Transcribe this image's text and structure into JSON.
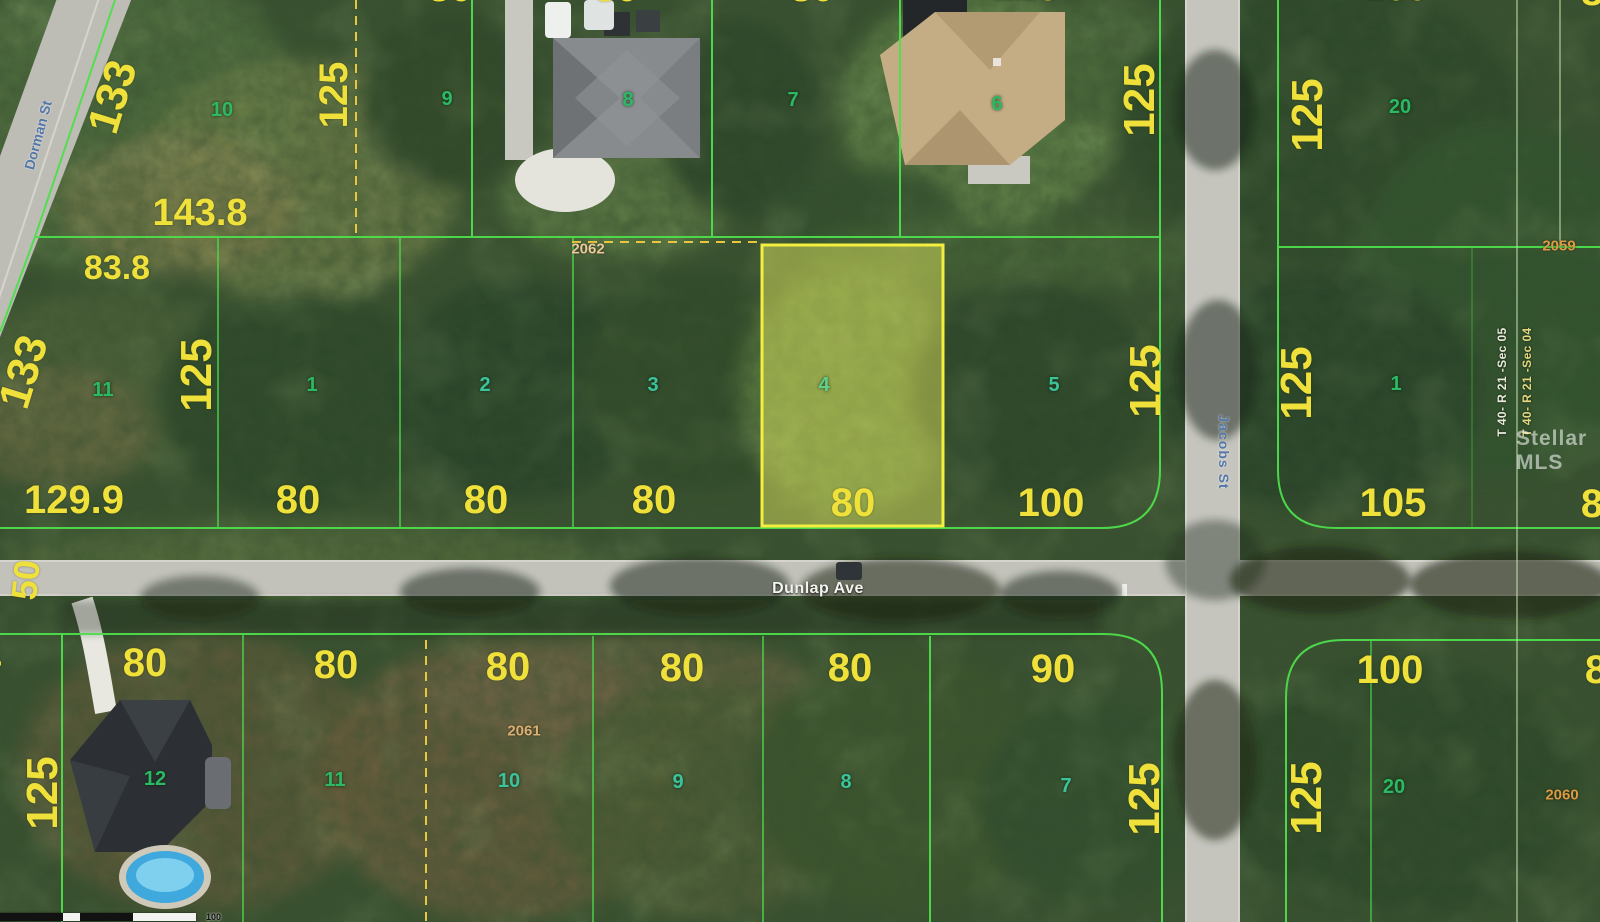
{
  "colors": {
    "dimension_yellow": "#f0e03a",
    "lot_number_green": "#2db863",
    "parcel_id_orange": "#dd9a42",
    "boundary_green": "#4ede4c",
    "highlight_yellow": "#f4ee3e",
    "dashed_yellow": "#e7c73e",
    "street_label_blue": "#5577a8",
    "street_label_white": "#f4f4ee"
  },
  "streets": {
    "dunlap": "Dunlap Ave",
    "jacobs": "Jacobs St",
    "dorman": "Dorman St"
  },
  "watermark": "Stellar MLS",
  "sections": {
    "sec05": "T 40- R 21 -Sec 05",
    "sec04": "T 40- R 21 -Sec 04"
  },
  "scale_bar": {
    "label": "100"
  },
  "north_west": {
    "lot_numbers": {
      "n10": "10",
      "n9": "9",
      "n8": "8",
      "n7": "7",
      "n6": "6"
    },
    "dims": {
      "d133": "133",
      "d125_w": "125",
      "d125_e": "125",
      "d143_8": "143.8",
      "d83_8": "83.8"
    },
    "parcel_id": "2062"
  },
  "north_east": {
    "lot_numbers": {
      "n20": "20"
    },
    "dims": {
      "d125": "125"
    },
    "parcel_id": "2059"
  },
  "mid_west": {
    "lot_numbers": {
      "n11": "11",
      "n1": "1",
      "n2": "2",
      "n3": "3",
      "n4": "4",
      "n5": "5"
    },
    "dims": {
      "d133": "133",
      "d125_w": "125",
      "d125_e": "125",
      "d129_9": "129.9",
      "w80_1": "80",
      "w80_2": "80",
      "w80_3": "80",
      "w80_4": "80",
      "w100": "100",
      "d50": "50"
    }
  },
  "mid_east": {
    "lot_numbers": {
      "n1": "1"
    },
    "dims": {
      "d125": "125",
      "d105": "105",
      "w8_partial": "8"
    }
  },
  "south_west": {
    "lot_numbers": {
      "n12": "12",
      "n11": "11",
      "n10": "10",
      "n9": "9",
      "n8": "8",
      "n7": "7"
    },
    "dims": {
      "w4_partial": "4",
      "w80_1": "80",
      "w80_2": "80",
      "w80_3": "80",
      "w80_4": "80",
      "w80_5": "80",
      "w90": "90",
      "d125_w": "125",
      "d125_e": "125"
    },
    "parcel_id": "2061"
  },
  "south_east": {
    "lot_numbers": {
      "n20": "20"
    },
    "dims": {
      "w100": "100",
      "d125": "125",
      "w8_partial": "8"
    },
    "parcel_id": "2060"
  },
  "top_edge_partials": {
    "p80_a": "80",
    "p80_b": "80",
    "p80_c": "80",
    "p125": "125",
    "p100": "100",
    "p8": "8"
  }
}
